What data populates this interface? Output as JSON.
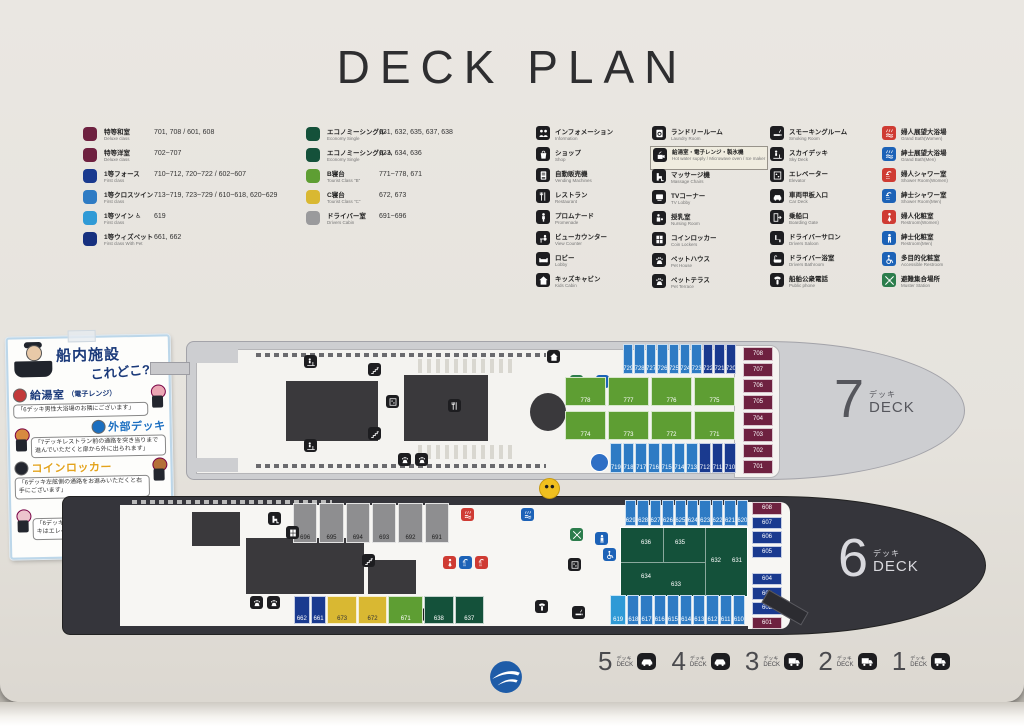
{
  "title": "DECK PLAN",
  "legend": {
    "rooms_col1": [
      {
        "sq": "#6e2140",
        "jp": "特等和室",
        "en": "Deluxe class",
        "rooms": "701, 708 / 601, 608"
      },
      {
        "sq": "#6e2140",
        "jp": "特等洋室",
        "en": "Deluxe class",
        "rooms": "702~707"
      },
      {
        "sq": "#1a3a8f",
        "jp": "1等フォース",
        "en": "First class",
        "rooms": "710~712, 720~722 / 602~607"
      },
      {
        "sq": "#2e7bc4",
        "jp": "1等クロスツイン",
        "en": "First class",
        "rooms": "713~719, 723~729 / 610~618, 620~629"
      },
      {
        "sq": "#2f9ad6",
        "jp": "1等ツイン ♿",
        "en": "First class",
        "rooms": "619"
      },
      {
        "sq": "#16307f",
        "jp": "1等ウィズペット",
        "en": "First class With Pet",
        "rooms": "661, 662"
      }
    ],
    "rooms_col2": [
      {
        "sq": "#14513a",
        "jp": "エコノミーシングル",
        "en": "Economy Single",
        "rooms": "631, 632, 635, 637, 638"
      },
      {
        "sq": "#14513a",
        "jp": "エコノミーシングル ♿",
        "en": "Economy Single",
        "rooms": "633, 634, 636"
      },
      {
        "sq": "#5e9e33",
        "jp": "B寝台",
        "en": "Tourist Class \"B\"",
        "rooms": "771~778, 671"
      },
      {
        "sq": "#d9b832",
        "jp": "C寝台",
        "en": "Tourist Class \"C\"",
        "rooms": "672, 673"
      },
      {
        "sq": "#9a9a9c",
        "jp": "ドライバー室",
        "en": "Drivers Cabin",
        "rooms": "691~696"
      }
    ],
    "fac_col1": [
      {
        "icon": "people",
        "jp": "インフォメーション",
        "en": "Information"
      },
      {
        "icon": "bag",
        "jp": "ショップ",
        "en": "Shop"
      },
      {
        "icon": "vending",
        "jp": "自動販売機",
        "en": "Vending Machines"
      },
      {
        "icon": "restaurant",
        "jp": "レストラン",
        "en": "Restaurant"
      },
      {
        "icon": "promenade",
        "jp": "プロムナード",
        "en": "Promenade"
      },
      {
        "icon": "counter",
        "jp": "ビューカウンター",
        "en": "View Counter"
      },
      {
        "icon": "lobby",
        "jp": "ロビー",
        "en": "Lobby"
      },
      {
        "icon": "kids",
        "jp": "キッズキャビン",
        "en": "Kids Cabin"
      }
    ],
    "fac_col2": [
      {
        "icon": "laundry",
        "jp": "ランドリールーム",
        "en": "Laundry Room"
      },
      {
        "icon": "kitchen",
        "jp": "給湯室・電子レンジ・製氷機",
        "en": "Hot water supply / Microwave oven / Ice maker",
        "highlight": true
      },
      {
        "icon": "massage",
        "jp": "マッサージ機",
        "en": "Massage Chairs"
      },
      {
        "icon": "tv",
        "jp": "TVコーナー",
        "en": "TV Lobby"
      },
      {
        "icon": "nursing",
        "jp": "授乳室",
        "en": "Nursing Room"
      },
      {
        "icon": "locker",
        "jp": "コインロッカー",
        "en": "Coin Lockers"
      },
      {
        "icon": "pet",
        "jp": "ペットハウス",
        "en": "Pet House"
      },
      {
        "icon": "pet",
        "jp": "ペットテラス",
        "en": "Pet Terrace"
      }
    ],
    "fac_col3": [
      {
        "icon": "smoking",
        "jp": "スモーキングルーム",
        "en": "Smoking Room"
      },
      {
        "icon": "skydeck",
        "jp": "スカイデッキ",
        "en": "Sky Deck"
      },
      {
        "icon": "elevator",
        "jp": "エレベーター",
        "en": "Elevator"
      },
      {
        "icon": "cardeck",
        "jp": "車両甲板入口",
        "en": "Car Deck"
      },
      {
        "icon": "gate",
        "jp": "乗船口",
        "en": "Boarding Gate"
      },
      {
        "icon": "saloon",
        "jp": "ドライバーサロン",
        "en": "Drivers Saloon"
      },
      {
        "icon": "bathtub",
        "jp": "ドライバー浴室",
        "en": "Drivers Bathroom"
      },
      {
        "icon": "phone",
        "jp": "船舶公衆電話",
        "en": "Public phone"
      }
    ],
    "fac_col4": [
      {
        "icon": "bath",
        "jp": "婦人展望大浴場",
        "en": "Grand Bath(Women)",
        "color": "#cf3b33"
      },
      {
        "icon": "bath",
        "jp": "紳士展望大浴場",
        "en": "Grand Bath(Men)",
        "color": "#1c62b7"
      },
      {
        "icon": "shower",
        "jp": "婦人シャワー室",
        "en": "Shower Room(Women)",
        "color": "#cf3b33"
      },
      {
        "icon": "shower",
        "jp": "紳士シャワー室",
        "en": "Shower Room(Men)",
        "color": "#1c62b7"
      },
      {
        "icon": "woman",
        "jp": "婦人化粧室",
        "en": "Restroom(Women)",
        "color": "#cf3b33"
      },
      {
        "icon": "man",
        "jp": "紳士化粧室",
        "en": "Restroom(Men)",
        "color": "#1c62b7"
      },
      {
        "icon": "wheelchair",
        "jp": "多目的化粧室",
        "en": "Accessible Restroom",
        "color": "#1c62b7"
      },
      {
        "icon": "muster",
        "jp": "避難集合場所",
        "en": "Muster Station",
        "color": "#2c7d4c"
      }
    ]
  },
  "sticker": {
    "title1": "船内施設",
    "title2": "これどこ?!",
    "items": [
      {
        "badge": "給湯室",
        "suffix": "（電子レンジ）",
        "color": "#1b3a7a",
        "circle": "#c23a3a",
        "char": "pig",
        "char_color": "#eba7b4",
        "side": "r",
        "text": "「6デッキ男性大浴場のお隣にございます」"
      },
      {
        "badge": "外部デッキ",
        "suffix": "",
        "color": "#1c6fc0",
        "circle": "#1c6fc0",
        "char": "fox",
        "char_color": "#d88a3f",
        "side": "l",
        "text": "「7デッキレストラン前の通路を突き当りまで進んでいただくと扉から外に出られます」"
      },
      {
        "badge": "コインロッカー",
        "suffix": "",
        "color": "#e3a31c",
        "circle": "#23262e",
        "char": "bear",
        "char_color": "#b5703a",
        "side": "r",
        "text": "「6デッキ左舷側の通路をお進みいただくと右手にございます」"
      },
      {
        "badge": "喫煙所",
        "suffix": "",
        "color": "#2e8b40",
        "circle": "#2e8b40",
        "char": "rabbit",
        "char_color": "#ecc3cd",
        "side": "l",
        "text": "「6デッキは中央階段を正面に見て左側、7デッキはエレベーター横にございます」"
      }
    ]
  },
  "deck7": {
    "num": "7",
    "jp": "デッキ",
    "en": "DECK",
    "top": [
      {
        "n": "729",
        "c": "lb"
      },
      {
        "n": "728",
        "c": "lb"
      },
      {
        "n": "727",
        "c": "lb"
      },
      {
        "n": "726",
        "c": "lb"
      },
      {
        "n": "725",
        "c": "lb"
      },
      {
        "n": "724",
        "c": "lb"
      },
      {
        "n": "723",
        "c": "lb"
      },
      {
        "n": "722",
        "c": "db"
      },
      {
        "n": "721",
        "c": "db"
      },
      {
        "n": "720",
        "c": "db"
      }
    ],
    "bottom": [
      {
        "n": "719",
        "c": "lb"
      },
      {
        "n": "718",
        "c": "lb"
      },
      {
        "n": "717",
        "c": "lb"
      },
      {
        "n": "716",
        "c": "lb"
      },
      {
        "n": "715",
        "c": "lb"
      },
      {
        "n": "714",
        "c": "lb"
      },
      {
        "n": "713",
        "c": "lb"
      },
      {
        "n": "712",
        "c": "db"
      },
      {
        "n": "711",
        "c": "db"
      },
      {
        "n": "710",
        "c": "db"
      }
    ],
    "green_top": [
      {
        "n": "778",
        "c": "gn"
      },
      {
        "n": "777",
        "c": "gn"
      },
      {
        "n": "776",
        "c": "gn"
      },
      {
        "n": "775",
        "c": "gn"
      }
    ],
    "green_bottom": [
      {
        "n": "774",
        "c": "gn"
      },
      {
        "n": "773",
        "c": "gn"
      },
      {
        "n": "772",
        "c": "gn"
      },
      {
        "n": "771",
        "c": "gn"
      }
    ],
    "bow": [
      {
        "n": "708",
        "c": "mr"
      },
      {
        "n": "707",
        "c": "mr"
      },
      {
        "n": "706",
        "c": "mr"
      },
      {
        "n": "705",
        "c": "mr"
      },
      {
        "n": "704",
        "c": "mr"
      },
      {
        "n": "703",
        "c": "mr"
      },
      {
        "n": "702",
        "c": "mr"
      },
      {
        "n": "701",
        "c": "mr"
      }
    ]
  },
  "deck6": {
    "num": "6",
    "jp": "デッキ",
    "en": "DECK",
    "drivers": [
      {
        "n": "696",
        "c": "gr"
      },
      {
        "n": "695",
        "c": "gr"
      },
      {
        "n": "694",
        "c": "gr"
      },
      {
        "n": "693",
        "c": "gr"
      },
      {
        "n": "692",
        "c": "gr"
      },
      {
        "n": "691",
        "c": "gr"
      }
    ],
    "top": [
      {
        "n": "629",
        "c": "lb"
      },
      {
        "n": "628",
        "c": "lb"
      },
      {
        "n": "627",
        "c": "lb"
      },
      {
        "n": "626",
        "c": "lb"
      },
      {
        "n": "625",
        "c": "lb"
      },
      {
        "n": "624",
        "c": "lb"
      },
      {
        "n": "623",
        "c": "lb"
      },
      {
        "n": "622",
        "c": "lb"
      },
      {
        "n": "621",
        "c": "lb"
      },
      {
        "n": "620",
        "c": "lb"
      }
    ],
    "bottom": [
      {
        "n": "619",
        "c": "lt w16"
      },
      {
        "n": "618",
        "c": "lb"
      },
      {
        "n": "617",
        "c": "lb"
      },
      {
        "n": "616",
        "c": "lb"
      },
      {
        "n": "615",
        "c": "lb"
      },
      {
        "n": "614",
        "c": "lb"
      },
      {
        "n": "613",
        "c": "lb"
      },
      {
        "n": "612",
        "c": "lb"
      },
      {
        "n": "611",
        "c": "lb"
      },
      {
        "n": "610",
        "c": "lb"
      }
    ],
    "left_row": [
      {
        "n": "662",
        "c": "db"
      },
      {
        "n": "661",
        "c": "db"
      },
      {
        "n": "673",
        "c": "yl wm"
      },
      {
        "n": "672",
        "c": "yl wm"
      },
      {
        "n": "671",
        "c": "gn wl"
      },
      {
        "n": "638",
        "c": "dg wm"
      },
      {
        "n": "637",
        "c": "dg wm"
      }
    ],
    "eco": [
      "636",
      "635",
      "632",
      "631",
      "634",
      "633"
    ],
    "bow": [
      {
        "n": "608",
        "c": "mr"
      },
      {
        "n": "607",
        "c": "db"
      },
      {
        "n": "606",
        "c": "db"
      },
      {
        "n": "605",
        "c": "db"
      },
      {
        "n": "",
        "c": "sp"
      },
      {
        "n": "604",
        "c": "db"
      },
      {
        "n": "603",
        "c": "db"
      },
      {
        "n": "602",
        "c": "db"
      },
      {
        "n": "601",
        "c": "mr"
      }
    ]
  },
  "indicators": [
    {
      "num": "5",
      "jp": "デッキ",
      "en": "DECK",
      "vehicle": "car"
    },
    {
      "num": "4",
      "jp": "デッキ",
      "en": "DECK",
      "vehicle": "car"
    },
    {
      "num": "3",
      "jp": "デッキ",
      "en": "DECK",
      "vehicle": "truck"
    },
    {
      "num": "2",
      "jp": "デッキ",
      "en": "DECK",
      "vehicle": "truck"
    },
    {
      "num": "1",
      "jp": "デッキ",
      "en": "DECK",
      "vehicle": "truck"
    }
  ],
  "logo_color": "#1e5ca8"
}
